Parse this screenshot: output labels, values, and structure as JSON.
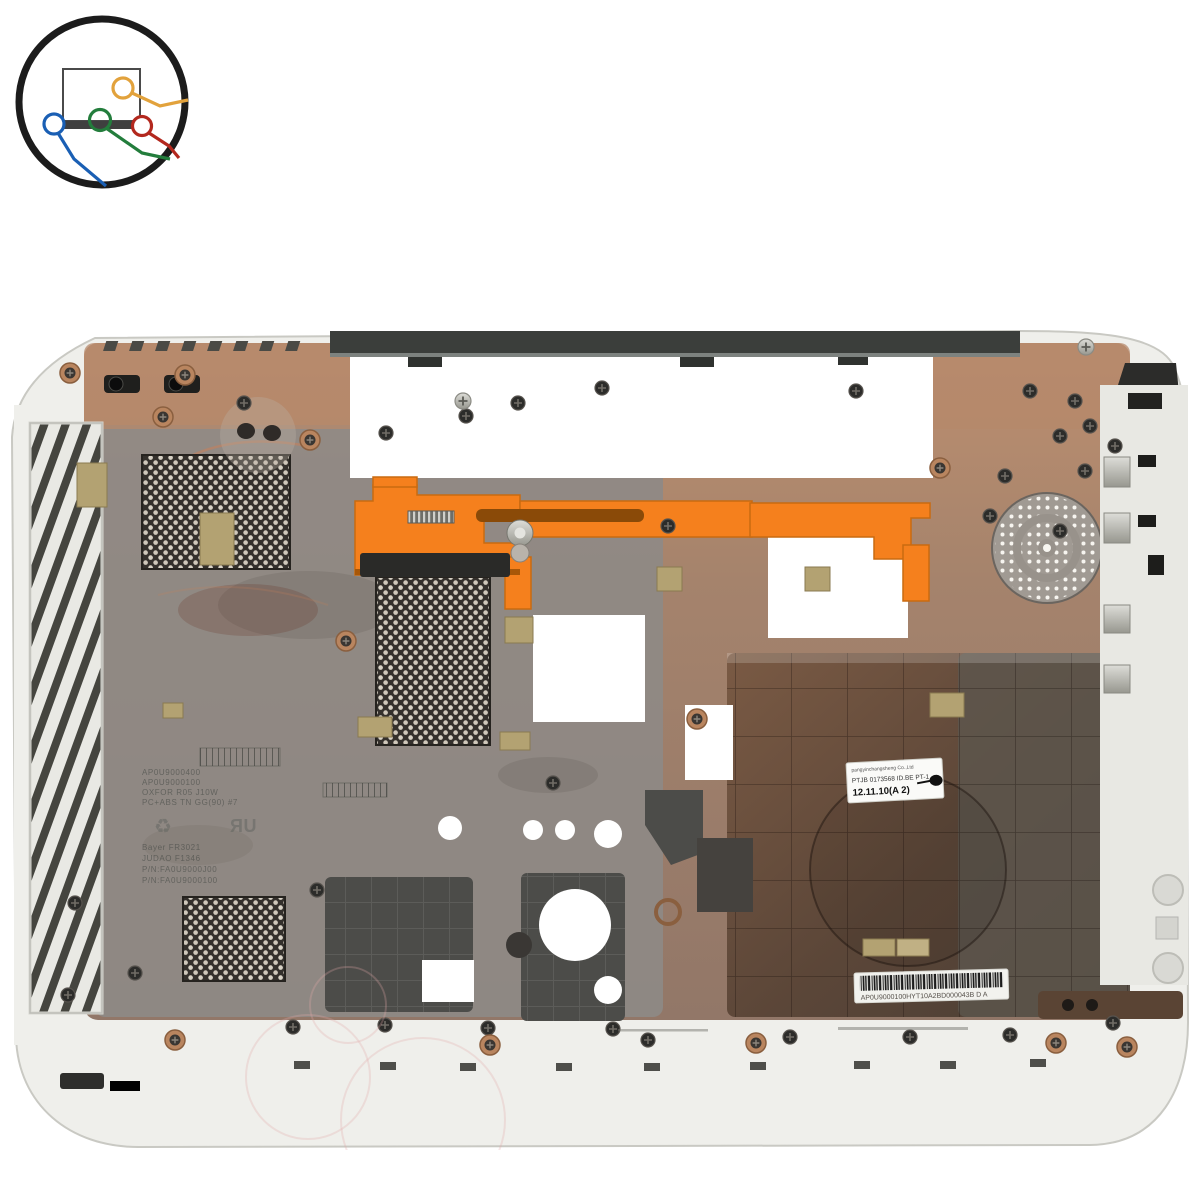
{
  "page": {
    "background_color": "#ffffff"
  },
  "logo": {
    "name": "laptop-with-cables-logo",
    "ring_color": "#1c1c1c",
    "wire_colors": {
      "orange": "#e2a23c",
      "blue": "#1a5fb4",
      "green": "#237d3c",
      "red": "#b3281e"
    }
  },
  "photo": {
    "part_colors": {
      "shell_white": "#efefeb",
      "copper": "#b5886b",
      "shield_gray": "#8e8a86",
      "latch_orange": "#f5801d",
      "battery_bay_brown": "#5e4a3c",
      "mesh_dark": "#34302c"
    },
    "date_label": {
      "line1": "pangyinchangsheng Co.,Ltd",
      "line2": "PTJB 0173568 ID.BE PT-1",
      "line3": "12.11.10(A  2)"
    },
    "barcode_label": {
      "text": "AP0U9000100HYT10A2BD000043B  D A"
    },
    "molded_text": {
      "lines": [
        "AP0U9000400",
        "AP0U9000100",
        "OXFOR R05 J10W",
        "PC+ABS TN GG(90) #7"
      ],
      "recycle_symbol": "♻",
      "ul_symbol": "ЯU",
      "lines2": [
        "Bayer  FR3021",
        "JUDAO  F1346",
        "P/N:FA0U9000J00",
        "P/N:FA0U9000100"
      ]
    }
  }
}
